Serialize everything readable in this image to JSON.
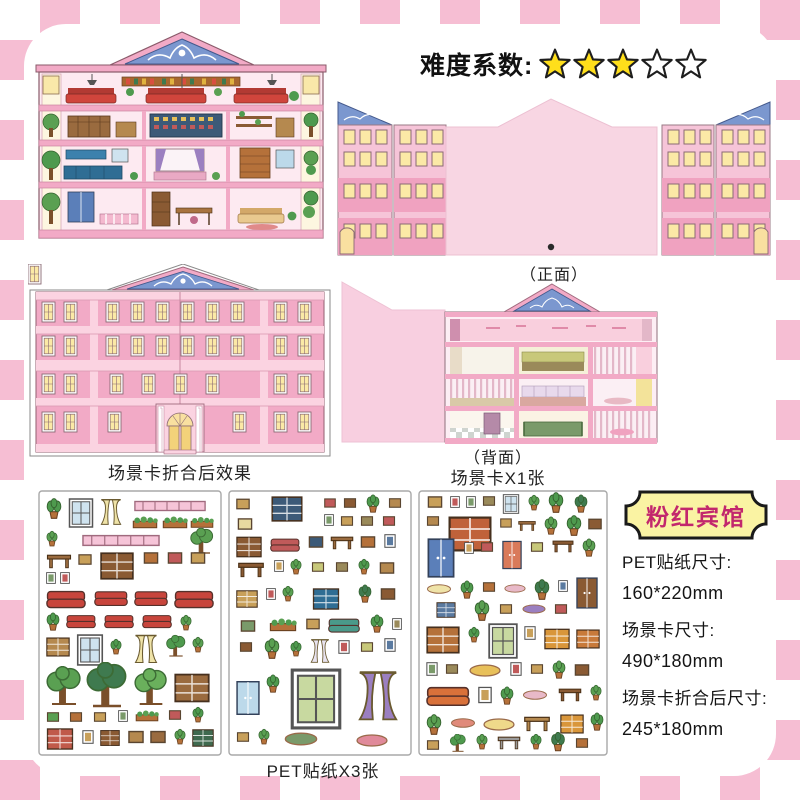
{
  "difficulty": {
    "label": "难度系数:",
    "stars_filled": 3,
    "stars_total": 5
  },
  "captions": {
    "front": "（正面）",
    "folded_effect": "场景卡折合后效果",
    "back": "（背面）",
    "scene_card_count": "场景卡X1张",
    "sticker_count": "PET贴纸X3张"
  },
  "product": {
    "name": "粉红宾馆",
    "specs": [
      {
        "label": "PET贴纸尺寸:",
        "value": "160*220mm"
      },
      {
        "label": "场景卡尺寸:",
        "value": "490*180mm"
      },
      {
        "label": "场景卡折合后尺寸:",
        "value": "245*180mm"
      }
    ]
  },
  "colors": {
    "checker_pink": "#f6bed3",
    "card_pink": "#f2aac6",
    "card_light_pink": "#fbd3e1",
    "blank_panel_pink": "#f8d6e3",
    "pediment_blue": "#7b97cf",
    "window_yellow": "#fbe9a6",
    "star_yellow": "#ffdf1b",
    "plaque_yellow": "#faf3a3",
    "plaque_text": "#c2276d"
  }
}
